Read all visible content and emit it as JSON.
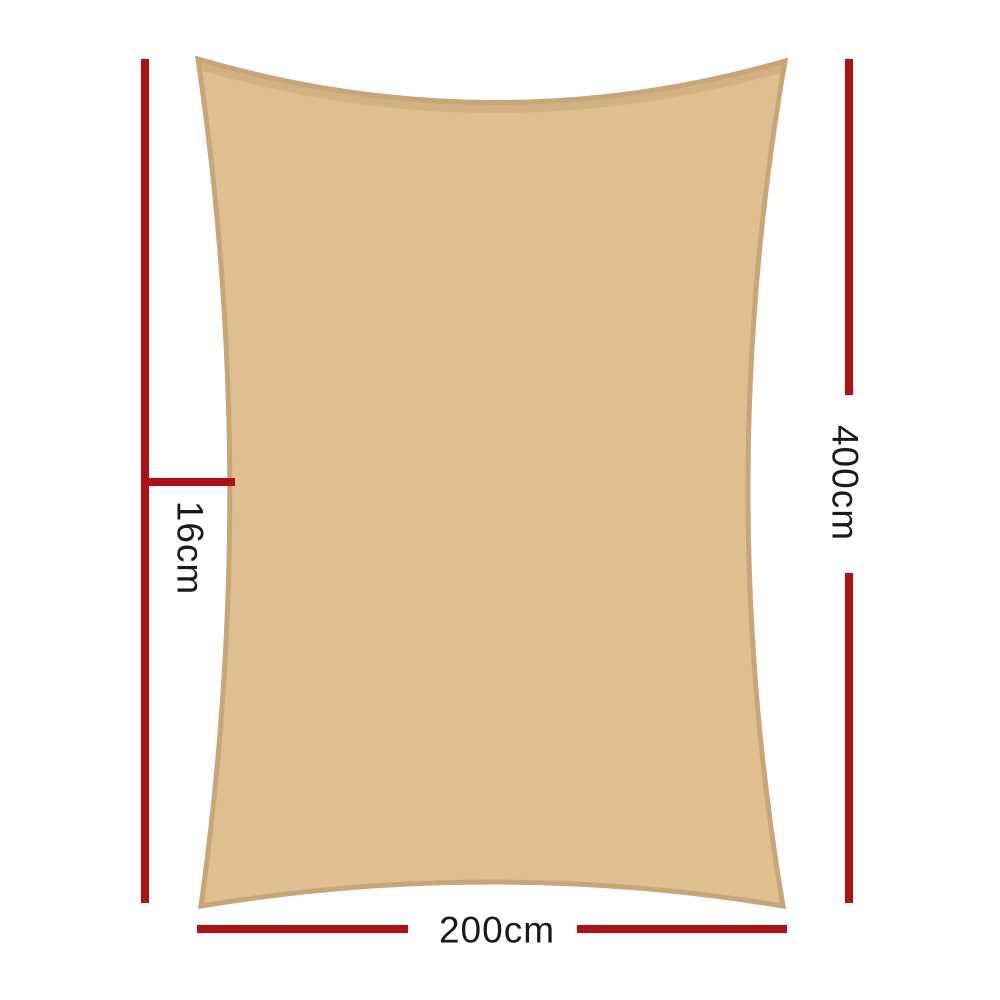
{
  "labels": {
    "width": "200cm",
    "height": "400cm",
    "edge_offset": "16cm"
  },
  "colors": {
    "sail_fill": "#DFBE8F",
    "sail_stroke": "#C8A679",
    "dimension_line": "#B01014",
    "label_text": "#1A1A1A",
    "background": "#FFFFFF"
  }
}
